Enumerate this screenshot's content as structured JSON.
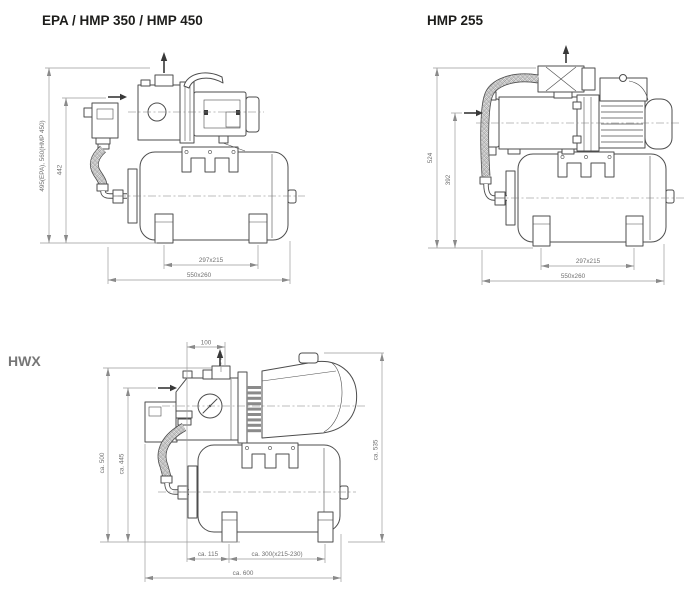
{
  "page": {
    "background": "#ffffff"
  },
  "colors": {
    "line": "#4d4d4d",
    "dimension_line": "#9a9a9a",
    "dimension_text": "#6f6f6f",
    "title_dark": "#1d1d1b",
    "title_gray": "#767676"
  },
  "diagrams": [
    {
      "title": "EPA / HMP 350 / HMP 450",
      "dims": {
        "height_outer": "495(EPA), 560(HMP 450)",
        "height_inner": "442",
        "feet": "297x215",
        "base": "550x260"
      }
    },
    {
      "title": "HMP 255",
      "dims": {
        "height_outer": "524",
        "height_inner": "392",
        "feet": "297x215",
        "base": "550x260"
      }
    },
    {
      "title": "HWX",
      "dims": {
        "top": "100",
        "height_outer": "ca. 500",
        "height_inner": "ca. 445",
        "height_right": "ca. 535",
        "foot_offset": "ca. 115",
        "feet": "ca. 300(x215-230)",
        "base": "ca. 600"
      }
    }
  ]
}
